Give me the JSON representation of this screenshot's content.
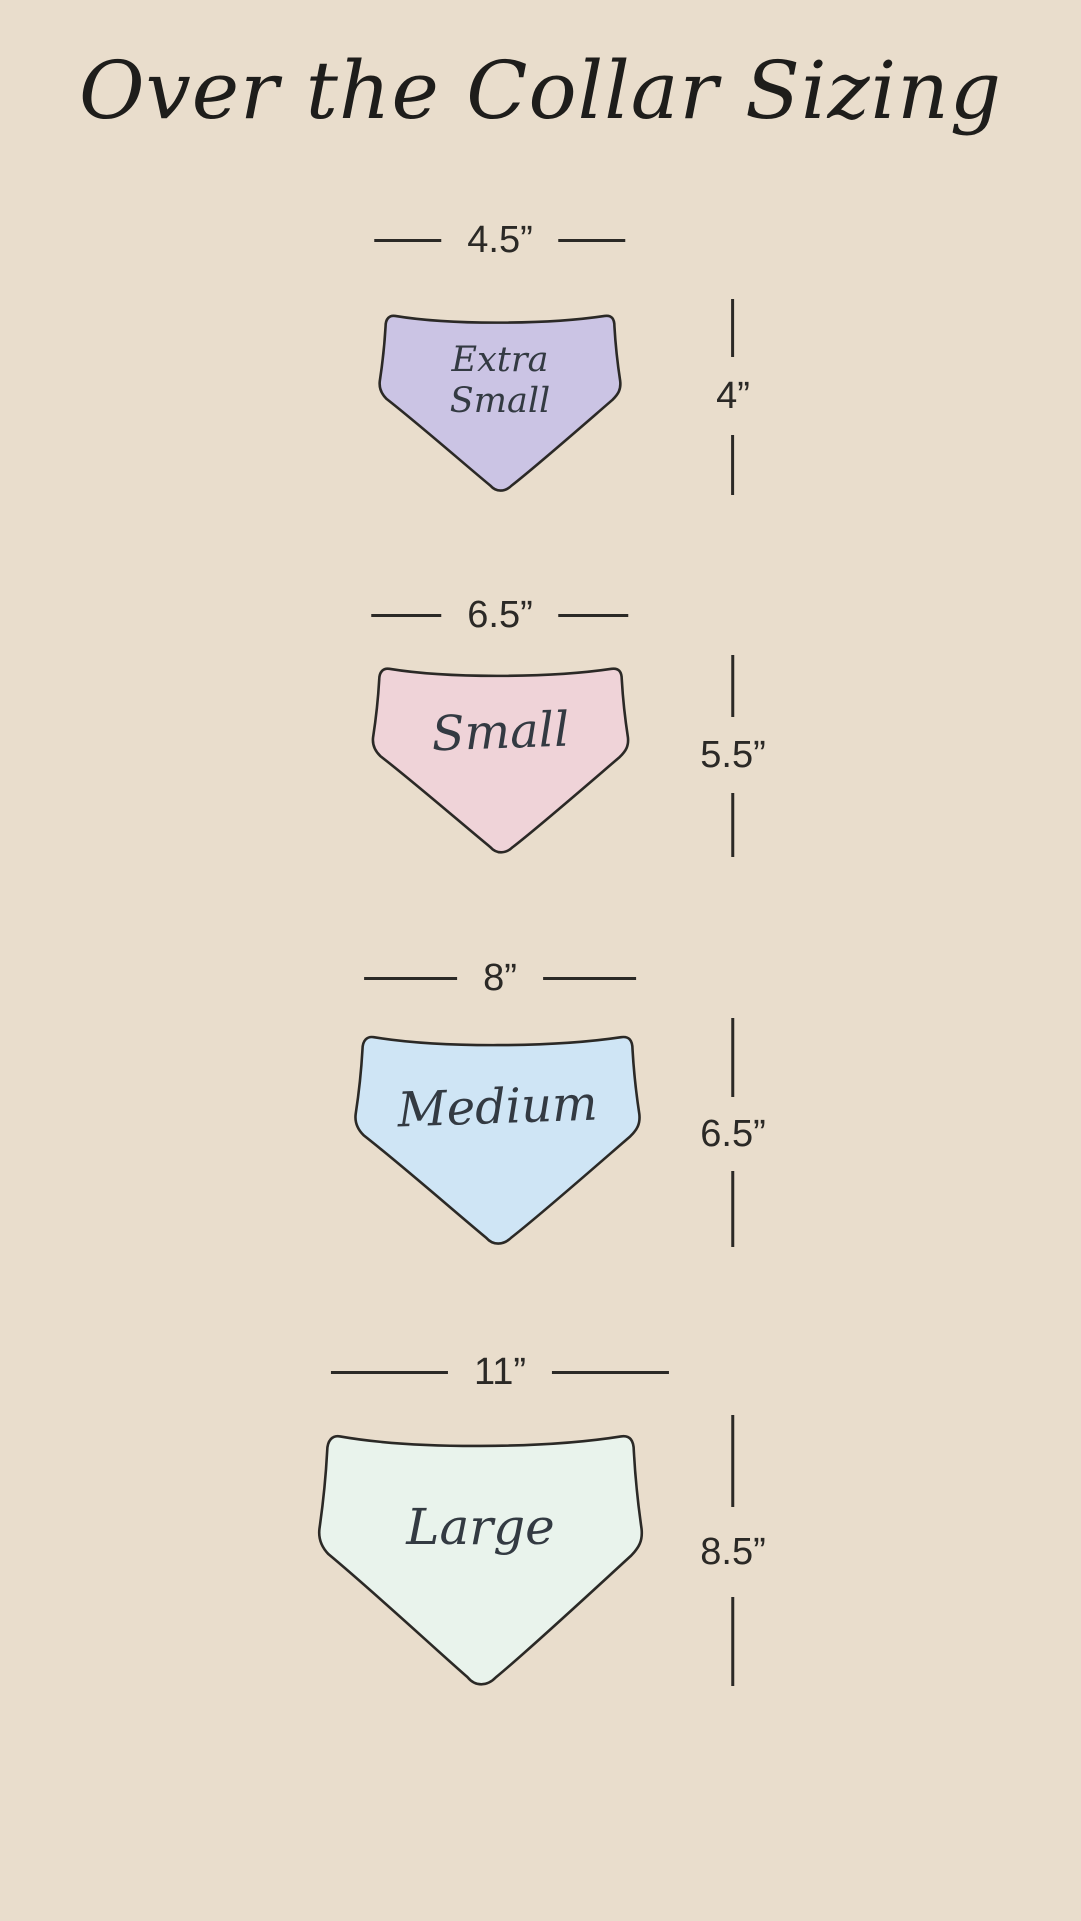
{
  "page": {
    "title": "Over the Collar Sizing",
    "background_color": "#e9ddcc",
    "outline_color": "#2b2926",
    "text_color": "#2b2926"
  },
  "sizes": [
    {
      "name": "Extra Small",
      "name_line1": "Extra",
      "name_line2": "Small",
      "width_label": "4.5”",
      "height_label": "4”",
      "fill": "#cbc4e4"
    },
    {
      "name": "Small",
      "width_label": "6.5”",
      "height_label": "5.5”",
      "fill": "#efd3d8"
    },
    {
      "name": "Medium",
      "width_label": "8”",
      "height_label": "6.5”",
      "fill": "#cfe5f5"
    },
    {
      "name": "Large",
      "width_label": "11”",
      "height_label": "8.5”",
      "fill": "#e9f3ec"
    }
  ]
}
